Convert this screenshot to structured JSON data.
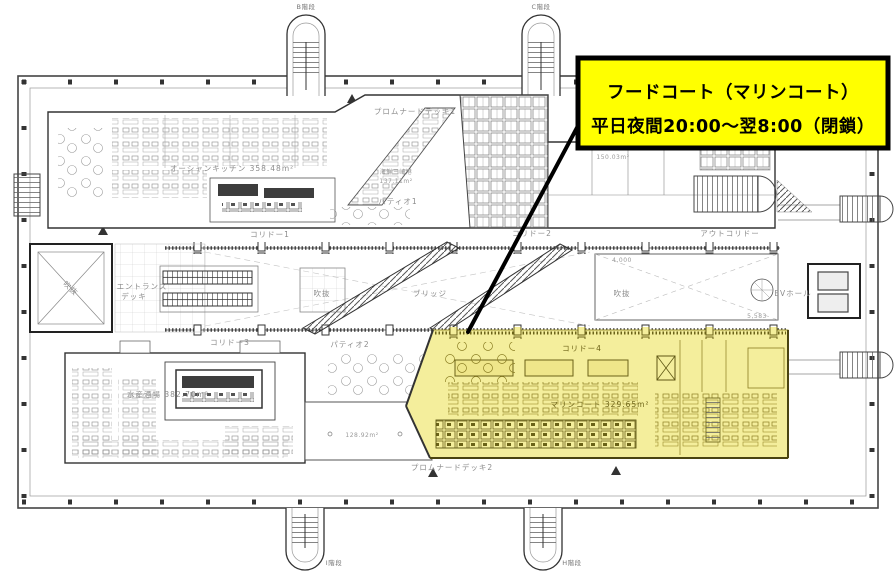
{
  "plan": {
    "callout": {
      "line1": "フードコート（マリンコート）",
      "line2": "平日夜間20:00～翌8:00（閉鎖）",
      "bg_color": "#ffff00",
      "border_color": "#000000"
    },
    "highlight_color": "#f4ee9c",
    "stairs": {
      "top_left": "B階段",
      "top_right": "C階段",
      "bottom_left": "I階段",
      "bottom_right": "H階段"
    },
    "corridors": {
      "c1": "コリドー1",
      "c2": "コリドー2",
      "c3": "コリドー3",
      "c4": "コリドー4",
      "out": "アウトコリドー"
    },
    "decks": {
      "promenade1": "プロムナードデッキ1",
      "promenade2": "プロムナードデッキ2",
      "entrance_line1": "エントランス",
      "entrance_line2": "デッキ",
      "open_area": "128.92m²"
    },
    "patios": {
      "p1": "パティオ1",
      "p2": "パティオ2"
    },
    "voids": {
      "left": "吹抜",
      "center": "吹抜",
      "right": "吹抜"
    },
    "bridge_label": "ブリッジ",
    "ev_hall": "EVホール",
    "tenants": {
      "ocean_kitchen": "オーシャンキッチン  358.48m²",
      "kaisen_name": "海鮮三崎港",
      "kaisen_area": "137.11m²",
      "umi_name": "うみのさち",
      "umi_area": "150.03m²",
      "suisan": "水産酒場 382.70m²",
      "marine_court": "マリンコート  329.65m²"
    },
    "dims": {
      "d1": "4,000",
      "d2": "5,583"
    }
  }
}
